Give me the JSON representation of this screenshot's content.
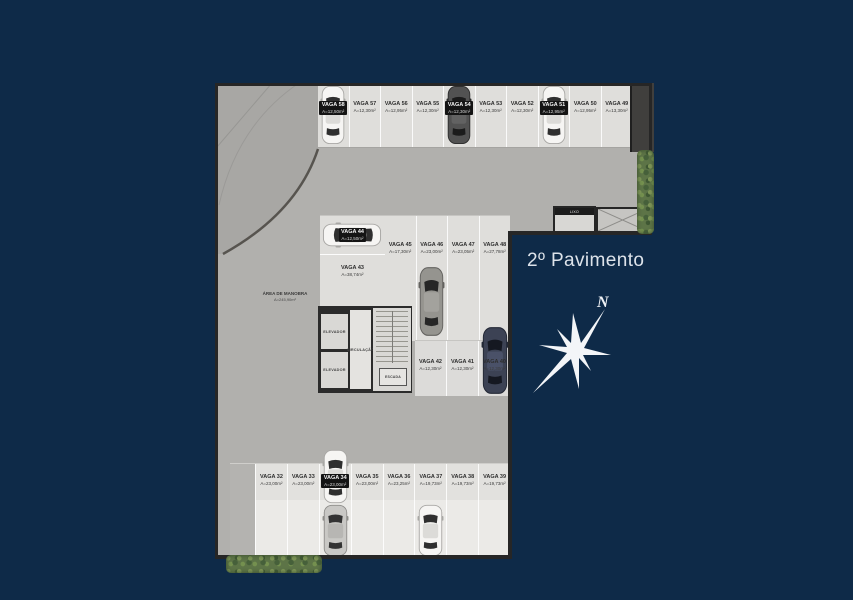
{
  "meta": {
    "floor_title": "2º Pavimento"
  },
  "compass": {
    "north": "N"
  },
  "colors": {
    "background": "#0e2a48",
    "floor_aisle": "#b1b0ad",
    "floor_stall": "#dfdedb",
    "wall": "#262626",
    "hedge_green": "#5d7447",
    "title_text": "#dde3ea",
    "badge_bg": "#141414"
  },
  "rooms": {
    "elevator1": "ELEVADOR",
    "elevator2": "ELEVADOR",
    "circulation": "CIRCULAÇÃO",
    "stairs": "ESCADA",
    "trash": "LIXO"
  },
  "annotations": {
    "maneuver_line1": "ÁREA DE MANOBRA",
    "maneuver_line2": "A=245,90m²"
  },
  "stalls": {
    "top_row": [
      {
        "name": "VAGA 58",
        "area": "A=12,50m²",
        "car": "white"
      },
      {
        "name": "VAGA 57",
        "area": "A=12,30m²"
      },
      {
        "name": "VAGA 56",
        "area": "A=12,95m²"
      },
      {
        "name": "VAGA 55",
        "area": "A=12,30m²"
      },
      {
        "name": "VAGA 54",
        "area": "A=12,30m²",
        "car": "dark"
      },
      {
        "name": "VAGA 53",
        "area": "A=12,30m²"
      },
      {
        "name": "VAGA 52",
        "area": "A=12,30m²"
      },
      {
        "name": "VAGA 51",
        "area": "A=12,95m²",
        "car": "white"
      },
      {
        "name": "VAGA 50",
        "area": "A=12,95m²"
      },
      {
        "name": "VAGA 49",
        "area": "A=13,30m²"
      }
    ],
    "mid_row": [
      {
        "name": "VAGA 45",
        "area": "A=17,30m²"
      },
      {
        "name": "VAGA 46",
        "area": "A=23,00m²",
        "car": "gray"
      },
      {
        "name": "VAGA 47",
        "area": "A=23,05m²"
      },
      {
        "name": "VAGA 48",
        "area": "A=27,78m²"
      }
    ],
    "stall_44": {
      "name": "VAGA 44",
      "area": "A=12,50m²",
      "car": "white"
    },
    "stall_43": {
      "name": "VAGA 43",
      "area": "A=38,74m²"
    },
    "low_row": [
      {
        "name": "VAGA 42",
        "area": "A=12,30m²"
      },
      {
        "name": "VAGA 41",
        "area": "A=12,30m²"
      },
      {
        "name": "VAGA 40",
        "area": "A=12,30m²",
        "car": "navy"
      }
    ],
    "bottom_row": [
      {
        "name": "VAGA 32",
        "area": "A=23,00m²"
      },
      {
        "name": "VAGA 33",
        "area": "A=23,00m²"
      },
      {
        "name": "VAGA 34",
        "area": "A=23,00m²",
        "car": "white",
        "car2": "silver"
      },
      {
        "name": "VAGA 35",
        "area": "A=23,00m²"
      },
      {
        "name": "VAGA 36",
        "area": "A=23,25m²"
      },
      {
        "name": "VAGA 37",
        "area": "A=19,73m²",
        "car": "white"
      },
      {
        "name": "VAGA 38",
        "area": "A=19,73m²"
      },
      {
        "name": "VAGA 39",
        "area": "A=19,73m²"
      }
    ]
  }
}
